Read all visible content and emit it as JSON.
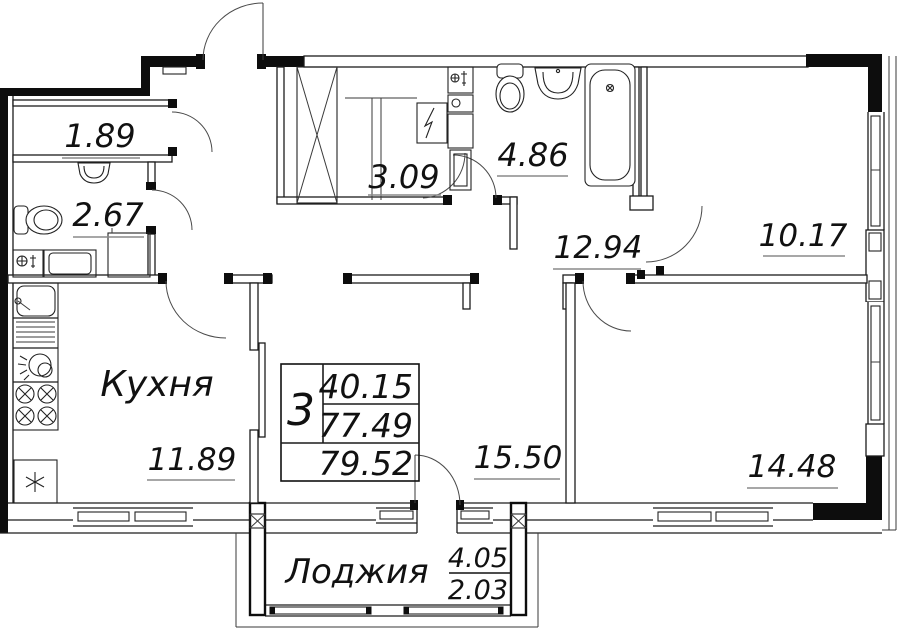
{
  "rooms": {
    "storage": {
      "area": "1.89"
    },
    "wc": {
      "area": "2.67"
    },
    "wardrobe": {
      "area": "3.09"
    },
    "bathroom": {
      "area": "4.86"
    },
    "hallway": {
      "area": "12.94"
    },
    "bedroom2": {
      "area": "10.17"
    },
    "kitchen": {
      "name": "Кухня",
      "area": "11.89"
    },
    "living": {
      "area": "15.50"
    },
    "bedroom1": {
      "area": "14.48"
    },
    "loggia": {
      "name": "Лоджия",
      "area_full": "4.05",
      "area_counted": "2.03"
    }
  },
  "summary": {
    "rooms_count": "3",
    "living_area": "40.15",
    "area_without_loggia": "77.49",
    "total_area": "79.52"
  }
}
